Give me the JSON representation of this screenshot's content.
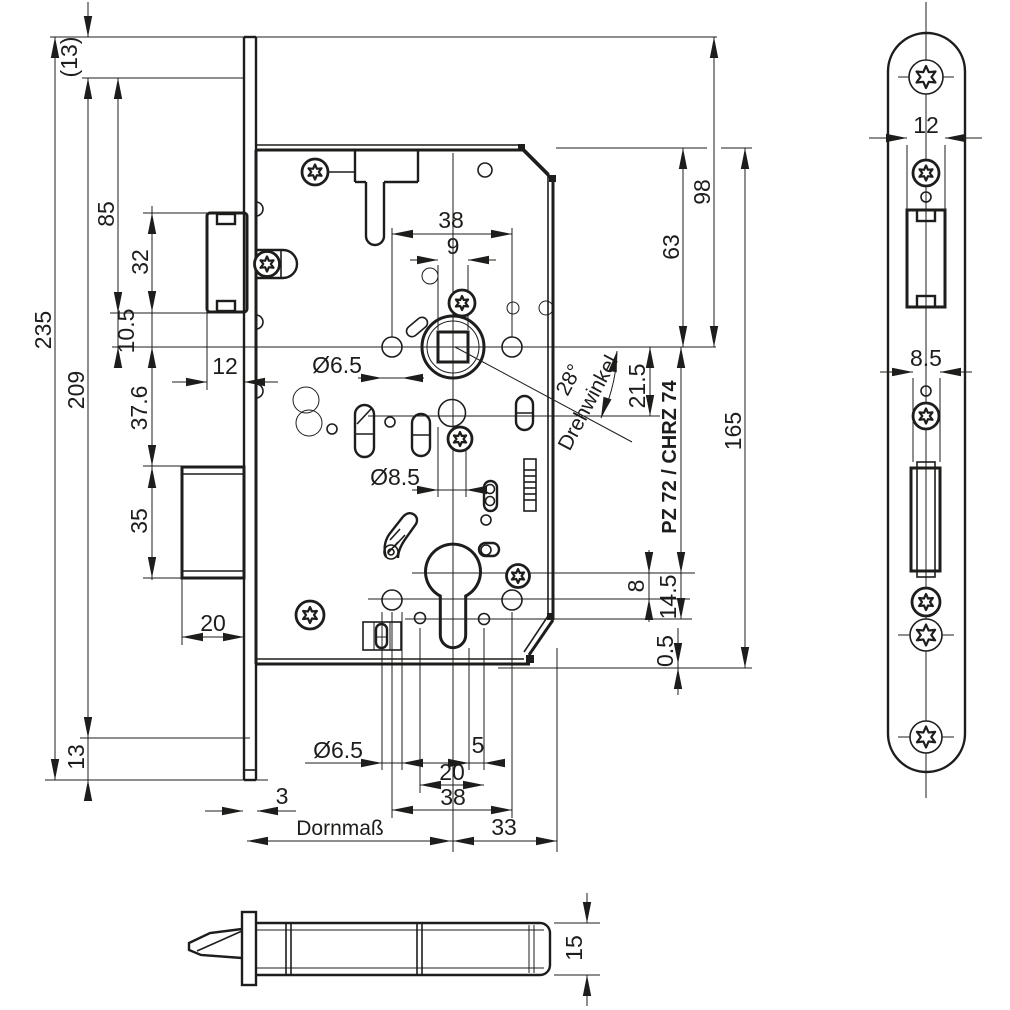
{
  "palette": {
    "line": "#1d1d1b",
    "background": "#ffffff"
  },
  "drawing": {
    "type": "technical-drawing",
    "subject": "mortise-lock-dimension-drawing"
  },
  "labels": {
    "paren_13": "(13)",
    "d235": "235",
    "d209": "209",
    "d85": "85",
    "d32": "32",
    "d10_5": "10.5",
    "d37_6": "37.6",
    "d35": "35",
    "d13": "13",
    "d12_latch": "12",
    "d20_bolt": "20",
    "d3": "3",
    "dornmass": "Dornmaß",
    "d33": "33",
    "d38_top": "38",
    "d9": "9",
    "dia65_top": "Ø6.5",
    "dia85_mid": "Ø8.5",
    "dia65_bot": "Ø6.5",
    "d5": "5",
    "d20_bot": "20",
    "d38_bot": "38",
    "d98": "98",
    "d63": "63",
    "d165": "165",
    "d21_5": "21.5",
    "angle_deg": "28°",
    "angle_word": "Drehwinkel",
    "variant": "PZ 72 / CHRZ 74",
    "d8": "8",
    "d14_5": "14.5",
    "d0_5": "0.5",
    "fp12": "12",
    "fp85": "8.5",
    "d15": "15"
  }
}
